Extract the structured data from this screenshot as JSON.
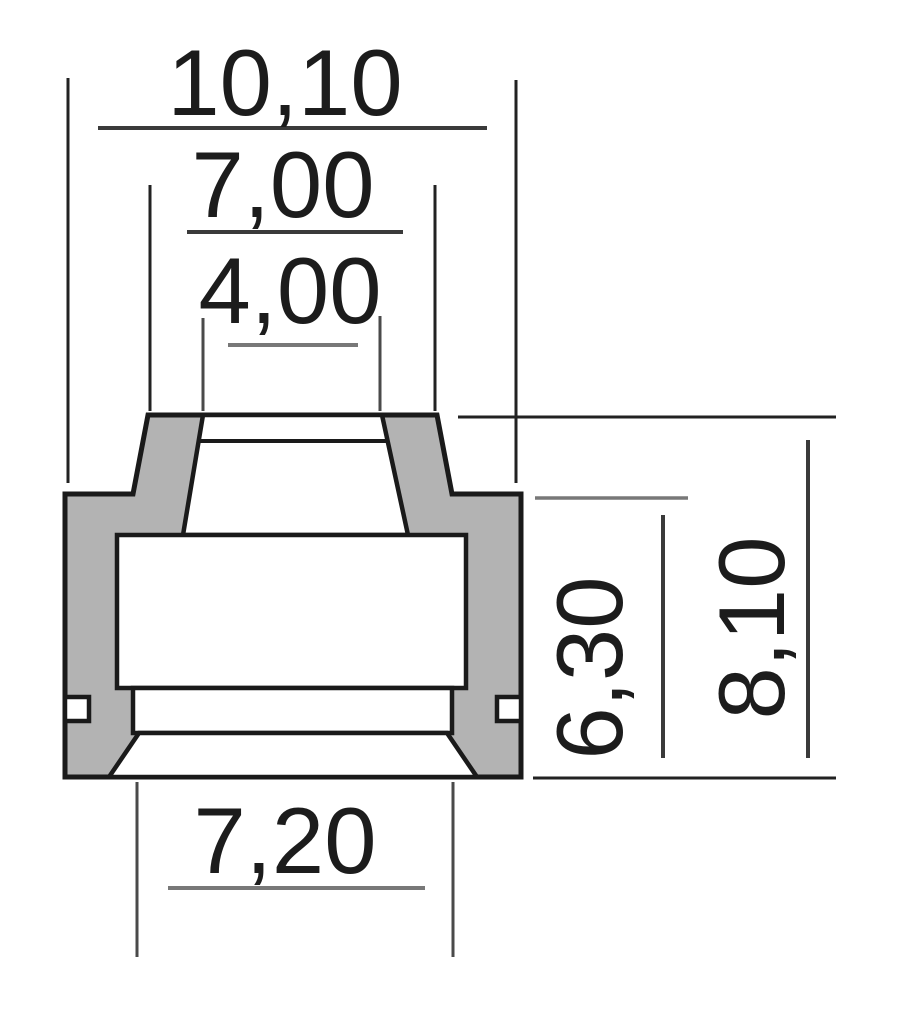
{
  "drawing": {
    "name": "seal-cross-section",
    "colors": {
      "background": "#ffffff",
      "body_fill": "#b3b3b3",
      "outline": "#1a1a1a",
      "dimension_line_light": "#787878",
      "text": "#1c1c1c"
    },
    "dimensions": {
      "outer_width_top": {
        "label": "10,10"
      },
      "shoulder_width": {
        "label": "7,00"
      },
      "bore_width_top": {
        "label": "4,00"
      },
      "bore_width_bottom": {
        "label": "7,20"
      },
      "body_height": {
        "label": "6,30"
      },
      "overall_height": {
        "label": "8,10"
      }
    }
  }
}
